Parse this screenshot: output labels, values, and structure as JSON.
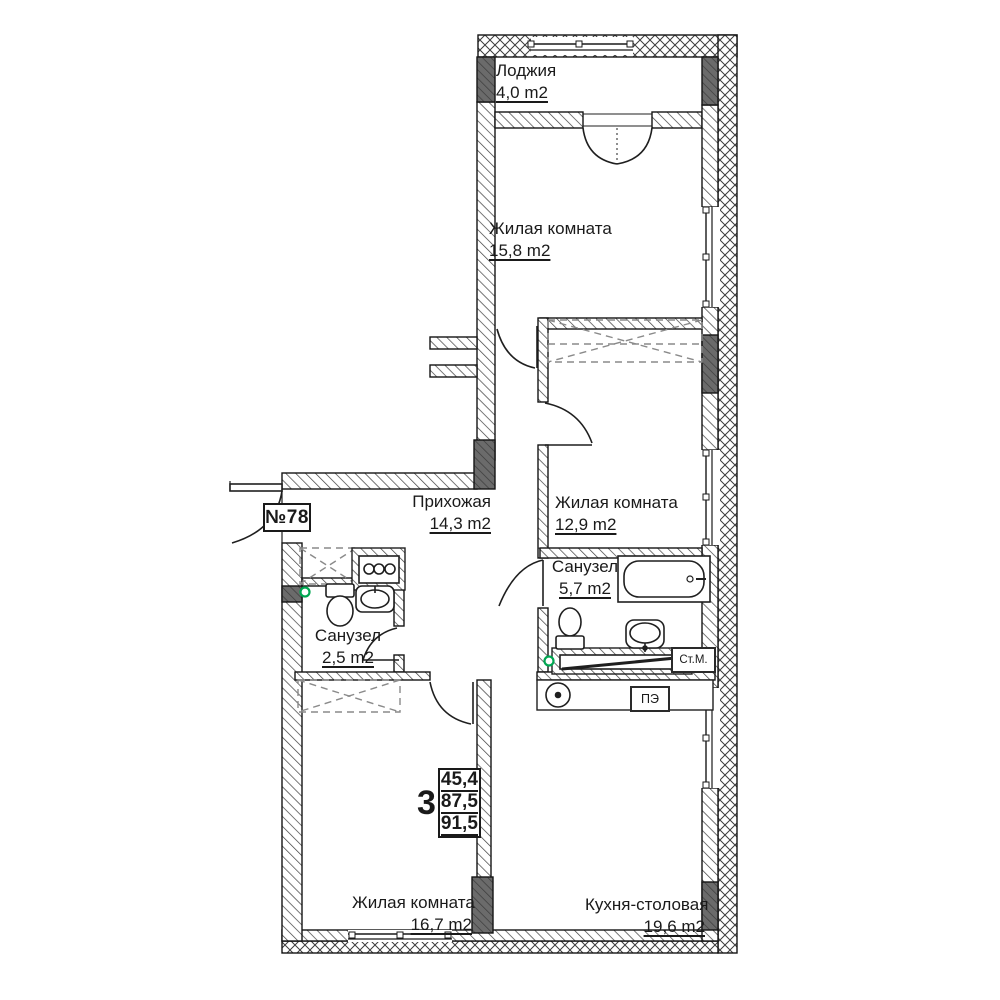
{
  "plan": {
    "apartment_number": "№78",
    "stamp": {
      "rooms_count": "3",
      "living_area": "45,4",
      "floor_area": "87,5",
      "total_area": "91,5"
    },
    "rooms": {
      "loggia": {
        "name": "Лоджия",
        "area": "4,0 m2"
      },
      "living_top": {
        "name": "Жилая комната",
        "area": "15,8 m2"
      },
      "living_mid": {
        "name": "Жилая комната",
        "area": "12,9 m2"
      },
      "hallway": {
        "name": "Прихожая",
        "area": "14,3 m2"
      },
      "bath_large": {
        "name": "Санузел",
        "area": "5,7 m2"
      },
      "bath_small": {
        "name": "Санузел",
        "area": "2,5 m2"
      },
      "living_bottom": {
        "name": "Жилая комната",
        "area": "16,7 m2"
      },
      "kitchen": {
        "name": "Кухня-столовая",
        "area": "19,6 m2"
      }
    },
    "appliances": {
      "washing_machine": "Ст.М.",
      "electric_stove": "ПЭ"
    },
    "colors": {
      "line": "#1a1a1a",
      "dark_fill": "#5f5f5f",
      "drain_green": "#00a651"
    }
  }
}
